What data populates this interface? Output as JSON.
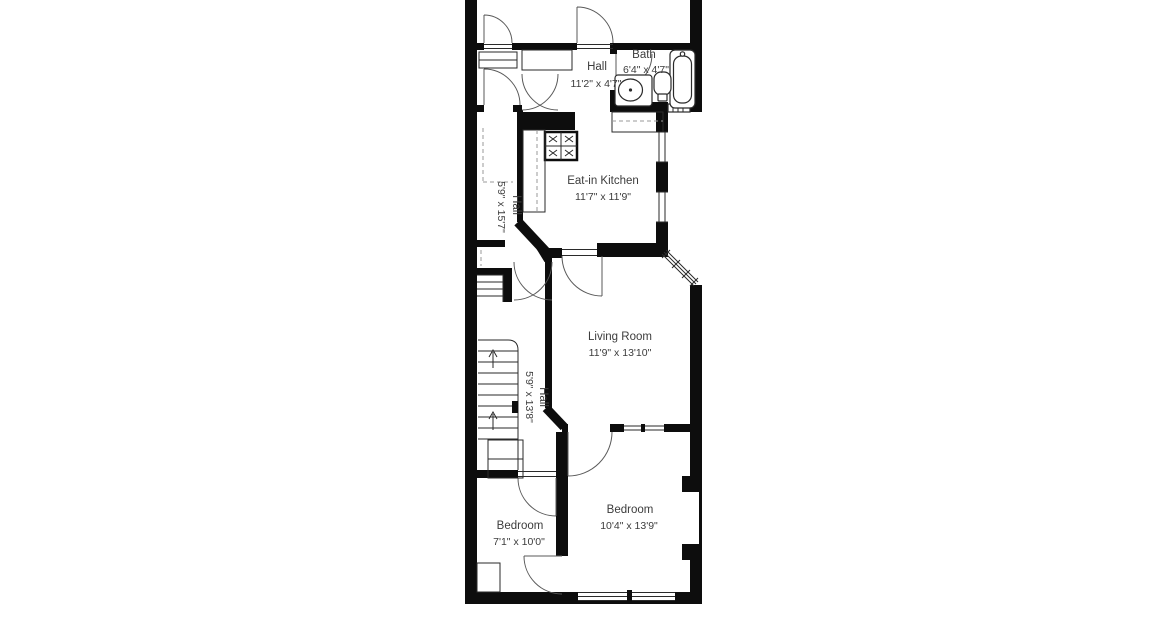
{
  "floor_plan": {
    "background_color": "#ffffff",
    "wall_color": "#0d0d0d",
    "text_color": "#3c3c3c",
    "rooms": [
      {
        "id": "hall-top",
        "name": "Hall",
        "dims": "11'2\" x 4'7\"",
        "orientation": "horizontal"
      },
      {
        "id": "bath",
        "name": "Bath",
        "dims": "6'4\" x 4'7\"",
        "orientation": "horizontal"
      },
      {
        "id": "kitchen",
        "name": "Eat-in Kitchen",
        "dims": "11'7\" x 11'9\"",
        "orientation": "horizontal"
      },
      {
        "id": "hall-upper",
        "name": "Hall",
        "dims": "5'9\" x 15'7\"",
        "orientation": "vertical"
      },
      {
        "id": "living-room",
        "name": "Living Room",
        "dims": "11'9\" x 13'10\"",
        "orientation": "horizontal"
      },
      {
        "id": "hall-lower",
        "name": "Hall",
        "dims": "5'9\" x 13'8\"",
        "orientation": "vertical"
      },
      {
        "id": "bedroom-small",
        "name": "Bedroom",
        "dims": "7'1\" x 10'0\"",
        "orientation": "horizontal"
      },
      {
        "id": "bedroom-large",
        "name": "Bedroom",
        "dims": "10'4\" x 13'9\"",
        "orientation": "horizontal"
      }
    ],
    "fixtures": [
      "bathtub",
      "toilet",
      "sink-vanity",
      "stove",
      "staircase",
      "kitchen-counter"
    ]
  }
}
